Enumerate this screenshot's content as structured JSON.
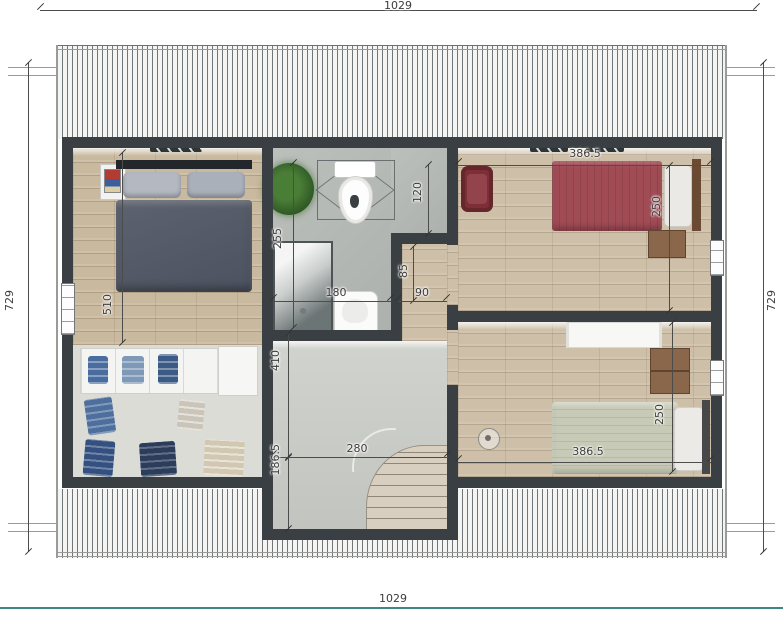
{
  "dimensions": {
    "overall_top": "1029",
    "overall_bottom": "1029",
    "overall_left": "729",
    "overall_right": "729",
    "master_bedroom_width": "510",
    "bathroom_depth": "255",
    "bathroom_nook_depth": "120",
    "shower_width": "180",
    "stair_landing_depth": "85",
    "stair_landing_width": "90",
    "hall_depth": "410",
    "stair_bay_depth": "186.5",
    "stair_bay_width": "280",
    "bedroom_top_right_width": "386.5",
    "bedroom_top_right_depth": "250",
    "bedroom_bottom_right_width": "386.5",
    "bedroom_bottom_right_depth": "250"
  },
  "colors": {
    "wall": "#3a3f43",
    "roof_hatch": "#70767a",
    "wood_floor_left": "#c9b99f",
    "wood_floor_right": "#cdbfa8",
    "bathroom_floor": "#b4b8b5",
    "stair_bay_floor": "#c9ccc7",
    "closet_floor": "#dbdbd6",
    "master_bed": "#565c68",
    "bed_top_right": "#a14b55",
    "bed_bottom_right": "#c6cab6",
    "plant": "#3a6b2d",
    "bottom_border_line": "#3d8787"
  }
}
